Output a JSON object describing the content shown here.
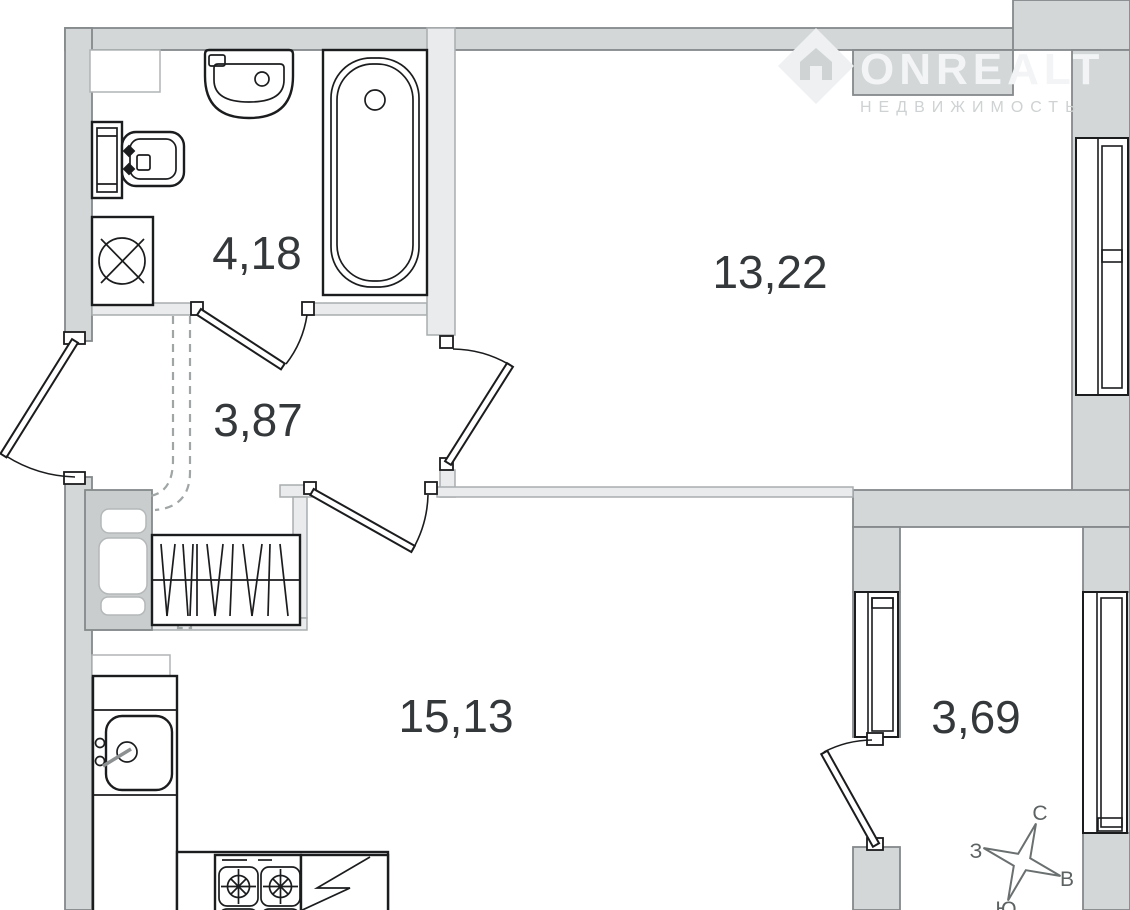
{
  "brand": {
    "name": "ONREALT",
    "tagline": "НЕДВИЖИМОСТЬ",
    "logo_icon": "house-in-diamond"
  },
  "rooms": [
    {
      "name": "bathroom",
      "area": "4,18"
    },
    {
      "name": "hallway",
      "area": "3,87"
    },
    {
      "name": "living-room",
      "area": "13,22"
    },
    {
      "name": "kitchen-living-room",
      "area": "15,13"
    },
    {
      "name": "balcony",
      "area": "3,69"
    }
  ],
  "compass": {
    "north": "С",
    "east": "В",
    "south": "Ю",
    "west": "З"
  },
  "fixtures": [
    "bathtub",
    "bathroom-sink",
    "toilet",
    "washing-machine",
    "wardrobe",
    "duct-shaft",
    "kitchen-counter",
    "kitchen-sink",
    "stove",
    "refrigerator"
  ],
  "colors": {
    "wall_fill": "#d3d7d8",
    "thin_wall_fill": "#e9ebec",
    "shaft_fill": "#c9cdce",
    "line": "#1b1c1e",
    "label": "#34383a",
    "watermark": "#f2f4f5",
    "watermark_tagline": "#ced2d3",
    "dash": "#a0a5a6"
  }
}
